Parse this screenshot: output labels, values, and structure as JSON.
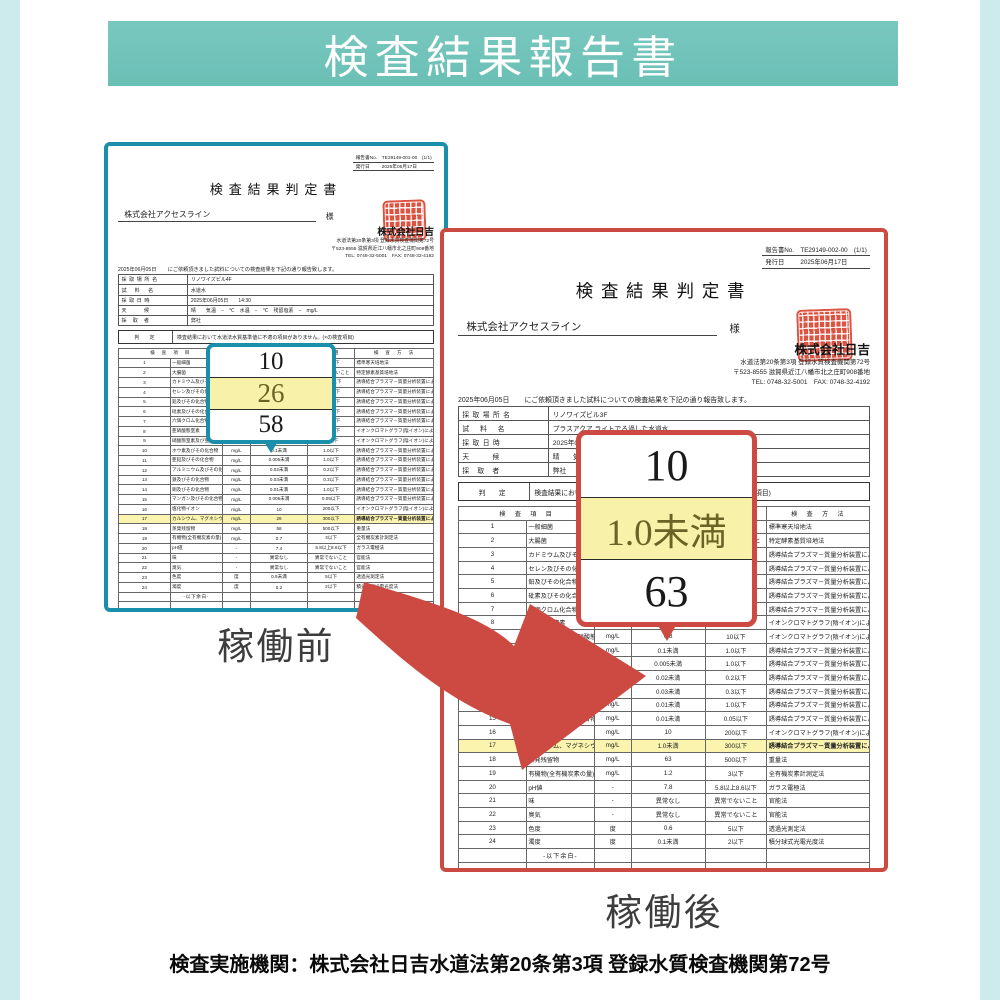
{
  "banner": {
    "title": "検査結果報告書"
  },
  "labels": {
    "before": "稼働前",
    "after": "稼働後"
  },
  "footer": {
    "text": "検査実施機関：株式会社日吉水道法第20条第3項  登録水質検査機関第72号"
  },
  "colors": {
    "banner_teal": "#6abfb5",
    "side_strip": "#cdeaec",
    "doc_before_border": "#1a8fab",
    "doc_after_border": "#cc4a42",
    "arrow_red": "#cc4a42",
    "highlight_yellow": "#faf4ae",
    "seal_red": "#dc5342"
  },
  "doc_before": {
    "report_no_label": "報告書No.",
    "report_no": "TE29149-001-00　(1/1)",
    "issue_label": "発行日",
    "issue_date": "2025年06月17日",
    "title": "検査結果判定書",
    "client": "株式会社アクセスライン",
    "client_suffix": "様",
    "company": "株式会社日吉",
    "company_lines": [
      "水道法第20条第3項 登録水質検査機関第72号",
      "〒523-8555 滋賀県近江八幡市北之庄町908番地",
      "TEL: 0748-32-5001　FAX: 0748-32-4192"
    ],
    "intro_date": "2025年06月05日",
    "intro_text": "にご依頼頂きました試料についての検査結果を下記の通り報告致します。",
    "info_rows": [
      {
        "label": "採 取 場 所 名",
        "value": "リノワイズビル4F"
      },
      {
        "label": "試　 料　 名",
        "value": "水道水"
      },
      {
        "label": "採 取 日 時",
        "value": "2025年06月05日　　14:30"
      },
      {
        "label": "天　　　候",
        "value": "晴　　気温　−　℃　水温　−　℃　残留塩素　−　mg/L"
      },
      {
        "label": "採　取　者",
        "value": "弊社"
      }
    ],
    "judge_label": "判　定",
    "judge_text": "検査結果において水道法水質基準値に不適の項目がありません。(×の検査項目)",
    "table_headers": {
      "item": "検　査　項　目",
      "unit": "単位",
      "result": "検査結果",
      "std": "基準値",
      "method": "検　査　方　法"
    },
    "table_rows": [
      {
        "n": "1",
        "item": "一般細菌",
        "unit": "個/ml",
        "result": "0",
        "std": "100以下",
        "method": "標準寒天培地法"
      },
      {
        "n": "2",
        "item": "大腸菌",
        "unit": "-",
        "result": "不検出",
        "std": "検出されないこと",
        "method": "特定酵素基質培地法"
      },
      {
        "n": "3",
        "item": "カドミウム及びその化合物",
        "unit": "mg/L",
        "result": "0.0003未満",
        "std": "0.003以下",
        "method": "誘導結合プラズマ－質量分析装置による一斉分析法"
      },
      {
        "n": "4",
        "item": "セレン及びその化合物",
        "unit": "mg/L",
        "result": "0.001未満",
        "std": "0.01以下",
        "method": "誘導結合プラズマ－質量分析装置による一斉分析法"
      },
      {
        "n": "5",
        "item": "鉛及びその化合物",
        "unit": "mg/L",
        "result": "0.001未満",
        "std": "0.01以下",
        "method": "誘導結合プラズマ－質量分析装置による一斉分析法"
      },
      {
        "n": "6",
        "item": "砒素及びその化合物",
        "unit": "mg/L",
        "result": "0.001未満",
        "std": "0.01以下",
        "method": "誘導結合プラズマ－質量分析装置による一斉分析法"
      },
      {
        "n": "7",
        "item": "六価クロム化合物",
        "unit": "mg/L",
        "result": "0.002未満",
        "std": "0.02以下",
        "method": "誘導結合プラズマ－質量分析装置による一斉分析法"
      },
      {
        "n": "8",
        "item": "亜硝酸態窒素",
        "unit": "mg/L",
        "result": "0.004未満",
        "std": "0.04以下",
        "method": "イオンクロマトグラフ(陰イオン)による一斉分析法"
      },
      {
        "n": "9",
        "item": "硝酸態窒素及び亜硝酸態窒素",
        "unit": "mg/L",
        "result": "0.8",
        "std": "10以下",
        "method": "イオンクロマトグラフ(陰イオン)による一斉分析法"
      },
      {
        "n": "10",
        "item": "ホウ素及びその化合物",
        "unit": "mg/L",
        "result": "0.1未満",
        "std": "1.0以下",
        "method": "誘導結合プラズマ－質量分析装置による一斉分析法"
      },
      {
        "n": "11",
        "item": "亜鉛及びその化合物",
        "unit": "mg/L",
        "result": "0.005未満",
        "std": "1.0以下",
        "method": "誘導結合プラズマ－質量分析装置による一斉分析法"
      },
      {
        "n": "12",
        "item": "アルミニウム及びその化合物",
        "unit": "mg/L",
        "result": "0.02未満",
        "std": "0.2以下",
        "method": "誘導結合プラズマ－質量分析装置による一斉分析法"
      },
      {
        "n": "13",
        "item": "鉄及びその化合物",
        "unit": "mg/L",
        "result": "0.03未満",
        "std": "0.3以下",
        "method": "誘導結合プラズマ－質量分析装置による一斉分析法"
      },
      {
        "n": "14",
        "item": "銅及びその化合物",
        "unit": "mg/L",
        "result": "0.01未満",
        "std": "1.0以下",
        "method": "誘導結合プラズマ－質量分析装置による一斉分析法"
      },
      {
        "n": "15",
        "item": "マンガン及びその化合物",
        "unit": "mg/L",
        "result": "0.005未満",
        "std": "0.05以下",
        "method": "誘導結合プラズマ－質量分析装置による一斉分析法"
      },
      {
        "n": "16",
        "item": "塩化物イオン",
        "unit": "mg/L",
        "result": "10",
        "std": "200以下",
        "method": "イオンクロマトグラフ(陰イオン)による一斉分析法"
      },
      {
        "n": "17",
        "item": "カルシウム、マグネシウム等(硬度)",
        "unit": "mg/L",
        "result": "26",
        "std": "300以下",
        "method": "誘導結合プラズマ－質量分析装置による一斉分析法",
        "hl": true
      },
      {
        "n": "18",
        "item": "蒸発残留物",
        "unit": "mg/L",
        "result": "58",
        "std": "500以下",
        "method": "重量法"
      },
      {
        "n": "19",
        "item": "有機物(全有機炭素の量)",
        "unit": "mg/L",
        "result": "0.7",
        "std": "3以下",
        "method": "全有機炭素計測定法"
      },
      {
        "n": "20",
        "item": "pH値",
        "unit": "-",
        "result": "7.4",
        "std": "5.8以上8.6以下",
        "method": "ガラス電極法"
      },
      {
        "n": "21",
        "item": "味",
        "unit": "-",
        "result": "異常なし",
        "std": "異常でないこと",
        "method": "官能法"
      },
      {
        "n": "22",
        "item": "臭気",
        "unit": "-",
        "result": "異常なし",
        "std": "異常でないこと",
        "method": "官能法"
      },
      {
        "n": "23",
        "item": "色度",
        "unit": "度",
        "result": "0.5未満",
        "std": "5以下",
        "method": "透過光測定法"
      },
      {
        "n": "24",
        "item": "濁度",
        "unit": "度",
        "result": "0.2",
        "std": "2以下",
        "method": "積分球式光電光度法"
      },
      {
        "n": "",
        "item": "-以下余白-",
        "unit": "",
        "result": "",
        "std": "",
        "method": "",
        "cls": "note-row"
      },
      {
        "n": "",
        "item": "",
        "unit": "",
        "result": "",
        "std": "",
        "method": ""
      },
      {
        "n": "",
        "item": "",
        "unit": "",
        "result": "",
        "std": "",
        "method": ""
      },
      {
        "n": "",
        "item": "",
        "unit": "",
        "result": "",
        "std": "",
        "method": ""
      },
      {
        "n": "",
        "item": "",
        "unit": "",
        "result": "",
        "std": "",
        "method": ""
      }
    ],
    "remarks_label": "備　考",
    "remarks_text": "検査方法は平成15年厚生労働省告示第261号によるものです。",
    "manage_label": "管理No.",
    "manage_no": "DL2691",
    "callout": {
      "values": [
        "10",
        "26",
        "58"
      ],
      "highlight_index": 1
    }
  },
  "doc_after": {
    "report_no_label": "報告書No.",
    "report_no": "TE29149-002-00　(1/1)",
    "issue_label": "発行日",
    "issue_date": "2025年06月17日",
    "title": "検査結果判定書",
    "client": "株式会社アクセスライン",
    "client_suffix": "様",
    "company": "株式会社日吉",
    "company_lines": [
      "水道法第20条第3項 登録水質検査機関第72号",
      "〒523-8555 滋賀県近江八幡市北之庄町908番地",
      "TEL: 0748-32-5001　FAX: 0748-32-4192"
    ],
    "intro_date": "2025年06月05日",
    "intro_text": "にご依頼頂きました試料についての検査結果を下記の通り報告致します。",
    "info_rows": [
      {
        "label": "採 取 場 所 名",
        "value": "リノワイズビル3F"
      },
      {
        "label": "試　 料　 名",
        "value": "プラスアクア ライトでろ過した水道水"
      },
      {
        "label": "採 取 日 時",
        "value": "2025年06月05日　　14:30"
      },
      {
        "label": "天　　　候",
        "value": "晴　　気温　−　℃　水温　−　℃　残留塩素　−　mg/L"
      },
      {
        "label": "採　取　者",
        "value": "弊社"
      }
    ],
    "judge_label": "判　定",
    "judge_text": "検査結果において水道法水質基準値に不適の項目がありません。(×の検査項目)",
    "table_headers": {
      "item": "検　査　項　目",
      "unit": "単位",
      "result": "検査結果",
      "std": "基準値",
      "method": "検　査　方　法"
    },
    "table_rows": [
      {
        "n": "1",
        "item": "一般細菌",
        "unit": "個/ml",
        "result": "0",
        "std": "100以下",
        "method": "標準寒天培地法"
      },
      {
        "n": "2",
        "item": "大腸菌",
        "unit": "-",
        "result": "不検出",
        "std": "検出されないこと",
        "method": "特定酵素基質培地法"
      },
      {
        "n": "3",
        "item": "カドミウム及びその化合物",
        "unit": "mg/L",
        "result": "0.0003未満",
        "std": "0.003以下",
        "method": "誘導結合プラズマ－質量分析装置による一斉分析法"
      },
      {
        "n": "4",
        "item": "セレン及びその化合物",
        "unit": "mg/L",
        "result": "0.001未満",
        "std": "0.01以下",
        "method": "誘導結合プラズマ－質量分析装置による一斉分析法"
      },
      {
        "n": "5",
        "item": "鉛及びその化合物",
        "unit": "mg/L",
        "result": "0.001未満",
        "std": "0.01以下",
        "method": "誘導結合プラズマ－質量分析装置による一斉分析法"
      },
      {
        "n": "6",
        "item": "砒素及びその化合物",
        "unit": "mg/L",
        "result": "0.001未満",
        "std": "0.01以下",
        "method": "誘導結合プラズマ－質量分析装置による一斉分析法"
      },
      {
        "n": "7",
        "item": "六価クロム化合物",
        "unit": "mg/L",
        "result": "0.002未満",
        "std": "0.02以下",
        "method": "誘導結合プラズマ－質量分析装置による一斉分析法"
      },
      {
        "n": "8",
        "item": "亜硝酸態窒素",
        "unit": "mg/L",
        "result": "0.004未満",
        "std": "0.04以下",
        "method": "イオンクロマトグラフ(陰イオン)による一斉分析法"
      },
      {
        "n": "9",
        "item": "硝酸態窒素及び亜硝酸態窒素",
        "unit": "mg/L",
        "result": "0.8",
        "std": "10以下",
        "method": "イオンクロマトグラフ(陰イオン)による一斉分析法"
      },
      {
        "n": "10",
        "item": "ホウ素及びその化合物",
        "unit": "mg/L",
        "result": "0.1未満",
        "std": "1.0以下",
        "method": "誘導結合プラズマ－質量分析装置による一斉分析法"
      },
      {
        "n": "11",
        "item": "亜鉛及びその化合物",
        "unit": "mg/L",
        "result": "0.005未満",
        "std": "1.0以下",
        "method": "誘導結合プラズマ－質量分析装置による一斉分析法"
      },
      {
        "n": "12",
        "item": "アルミニウム及びその化合物",
        "unit": "mg/L",
        "result": "0.02未満",
        "std": "0.2以下",
        "method": "誘導結合プラズマ－質量分析装置による一斉分析法"
      },
      {
        "n": "13",
        "item": "鉄及びその化合物",
        "unit": "mg/L",
        "result": "0.03未満",
        "std": "0.3以下",
        "method": "誘導結合プラズマ－質量分析装置による一斉分析法"
      },
      {
        "n": "14",
        "item": "銅及びその化合物",
        "unit": "mg/L",
        "result": "0.01未満",
        "std": "1.0以下",
        "method": "誘導結合プラズマ－質量分析装置による一斉分析法"
      },
      {
        "n": "15",
        "item": "マンガン及びその化合物",
        "unit": "mg/L",
        "result": "0.01未満",
        "std": "0.05以下",
        "method": "誘導結合プラズマ－質量分析装置による一斉分析法"
      },
      {
        "n": "16",
        "item": "塩化物イオン",
        "unit": "mg/L",
        "result": "10",
        "std": "200以下",
        "method": "イオンクロマトグラフ(陰イオン)による一斉分析法"
      },
      {
        "n": "17",
        "item": "カルシウム、マグネシウム等(硬度)",
        "unit": "mg/L",
        "result": "1.0未満",
        "std": "300以下",
        "method": "誘導結合プラズマ－質量分析装置による一斉分析法",
        "hl": true
      },
      {
        "n": "18",
        "item": "蒸発残留物",
        "unit": "mg/L",
        "result": "63",
        "std": "500以下",
        "method": "重量法"
      },
      {
        "n": "19",
        "item": "有機物(全有機炭素の量)",
        "unit": "mg/L",
        "result": "1.2",
        "std": "3以下",
        "method": "全有機炭素計測定法"
      },
      {
        "n": "20",
        "item": "pH値",
        "unit": "-",
        "result": "7.8",
        "std": "5.8以上8.6以下",
        "method": "ガラス電極法"
      },
      {
        "n": "21",
        "item": "味",
        "unit": "-",
        "result": "異常なし",
        "std": "異常でないこと",
        "method": "官能法"
      },
      {
        "n": "22",
        "item": "臭気",
        "unit": "-",
        "result": "異常なし",
        "std": "異常でないこと",
        "method": "官能法"
      },
      {
        "n": "23",
        "item": "色度",
        "unit": "度",
        "result": "0.6",
        "std": "5以下",
        "method": "透過光測定法"
      },
      {
        "n": "24",
        "item": "濁度",
        "unit": "度",
        "result": "0.1未満",
        "std": "2以下",
        "method": "積分球式光電光度法"
      },
      {
        "n": "",
        "item": "-以下余白-",
        "unit": "",
        "result": "",
        "std": "",
        "method": "",
        "cls": "note-row"
      },
      {
        "n": "",
        "item": "",
        "unit": "",
        "result": "",
        "std": "",
        "method": ""
      },
      {
        "n": "",
        "item": "",
        "unit": "",
        "result": "",
        "std": "",
        "method": ""
      },
      {
        "n": "",
        "item": "",
        "unit": "",
        "result": "",
        "std": "",
        "method": ""
      },
      {
        "n": "",
        "item": "",
        "unit": "",
        "result": "",
        "std": "",
        "method": ""
      }
    ],
    "remarks_label": "備　考",
    "remarks_text": "検査方法は平成15年厚生労働省告示第261号によるものです。",
    "manage_label": "管理No.",
    "manage_no": "DL2692",
    "callout": {
      "values": [
        "10",
        "1.0未満",
        "63"
      ],
      "highlight_index": 1
    }
  }
}
